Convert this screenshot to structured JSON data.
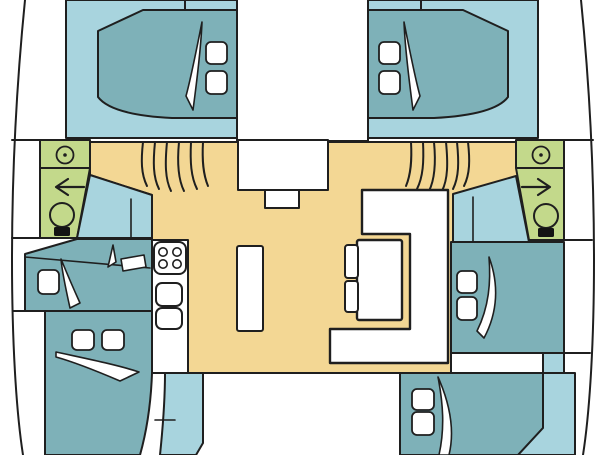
{
  "diagram": {
    "type": "floor-plan",
    "subject": "catamaran yacht deck layout, top view",
    "colors": {
      "background": "#ffffff",
      "outline": "#1f1f1f",
      "hull_floor": "#a8d4de",
      "bed": "#7eb1b8",
      "salon_floor": "#f3d794",
      "bathroom": "#c3d98b",
      "furniture": "#ffffff",
      "toilet_base": "#141414"
    },
    "areas": {
      "port_forward_cabin": "double berth with 2 pillows",
      "starboard_forward_cabin": "double berth with 2 pillows",
      "port_bathroom": "washbasin, shower, toilet",
      "starboard_bathroom": "washbasin, shower, toilet",
      "port_mid_cabin": "berth with 1 pillow and desk",
      "port_aft_cabin": "double berth with 2 pillows",
      "starboard_mid_cabin": "double berth with 2 pillows",
      "starboard_aft_cabin": "double berth with 2 pillows",
      "saloon": "open salon floor",
      "galley": "4-burner stove and double sink counter",
      "island": "island counter",
      "dinette": "U-shaped settee with table and 2 seats",
      "bow_deck": "foredeck with console",
      "cockpit": "aft cockpit",
      "stairs": "two companionway stairways, 6 treads each"
    },
    "counts": {
      "cabins": 6,
      "bathrooms": 2,
      "stove_burners": 4,
      "stair_treads_per_side": 6,
      "pillows_total": 11
    }
  }
}
